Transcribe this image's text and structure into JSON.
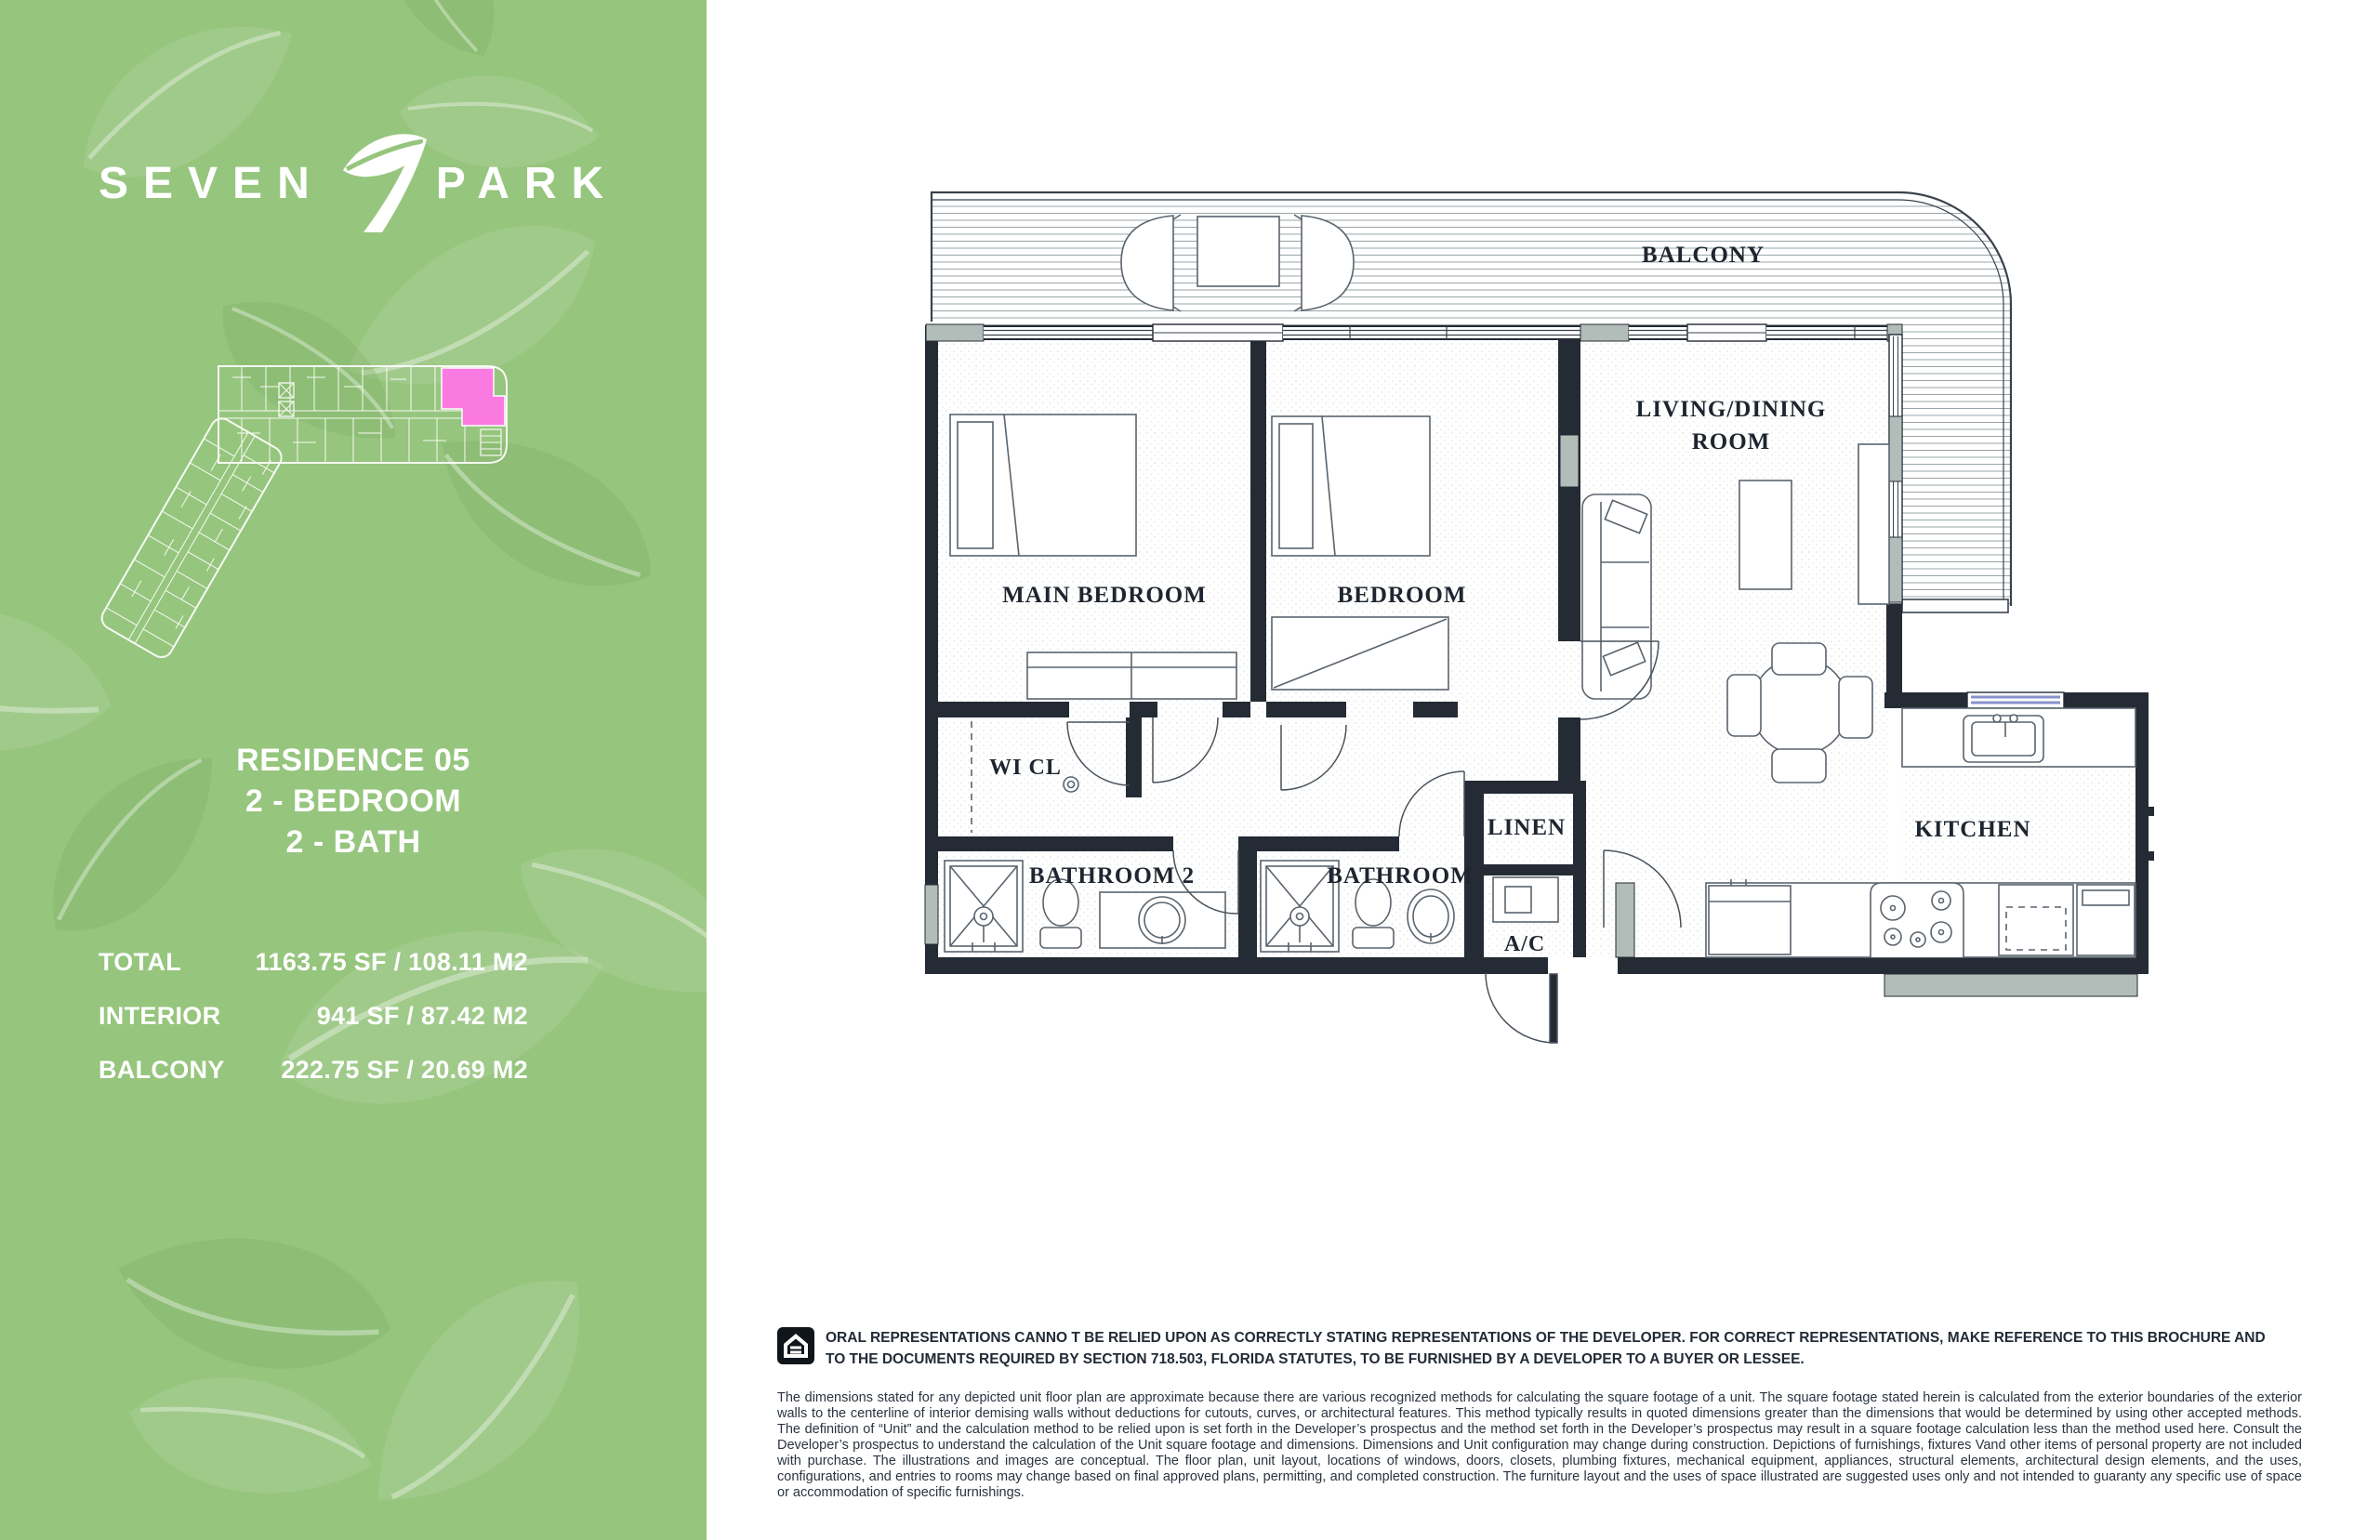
{
  "sidebar": {
    "logo": {
      "word1": "SEVEN",
      "word2": "PARK"
    },
    "residence": {
      "line1": "RESIDENCE 05",
      "line2": "2 - BEDROOM",
      "line3": "2 - BATH"
    },
    "areas": [
      {
        "label": "TOTAL",
        "value": "1163.75 SF / 108.11 M2"
      },
      {
        "label": "INTERIOR",
        "value": "941 SF / 87.42 M2"
      },
      {
        "label": "BALCONY",
        "value": "222.75 SF / 20.69 M2"
      }
    ]
  },
  "floorplan": {
    "rooms": {
      "balcony": "BALCONY",
      "main_bedroom": "MAIN BEDROOM",
      "bedroom": "BEDROOM",
      "living_line1": "LIVING/DINING",
      "living_line2": "ROOM",
      "wicl": "WI CL",
      "bathroom2": "BATHROOM 2",
      "bathroom": "BATHROOM",
      "linen": "LINEN",
      "ac": "A/C",
      "kitchen": "KITCHEN"
    }
  },
  "disclaimer": {
    "notice": "ORAL REPRESENTATIONS CANNO T BE RELIED UPON AS CORRECTLY STATING REPRESENTATIONS OF THE DEVELOPER. FOR CORRECT REPRESENTATIONS, MAKE REFERENCE TO THIS BROCHURE AND TO THE DOCUMENTS REQUIRED BY SECTION 718.503, FLORIDA STATUTES, TO BE FURNISHED BY A DEVELOPER TO A BUYER OR LESSEE.",
    "body": "The dimensions stated for any depicted unit floor plan are approximate because there are various recognized methods for calculating the square footage of a unit. The square footage stated herein is calculated from the exterior boundaries of the exterior walls to the centerline of interior demising walls without deductions for cutouts, curves, or architectural features. This method typically results in quoted dimensions greater than the dimensions that would be determined by using other accepted methods. The definition of “Unit” and the calculation method to be relied upon is set forth in the Developer’s prospectus and the method set forth in the Developer’s prospectus may result in a square footage calculation less than the method used here. Consult the Developer’s prospectus to understand the calculation of the Unit square footage and dimensions. Dimensions and Unit configuration may change during construction. Depictions of furnishings, fixtures Vand other items of personal property are not included with purchase. The illustrations and images are conceptual. The floor plan, unit layout, locations of windows, doors, closets, plumbing fixtures, mechanical equipment, appliances, structural elements, architectural design elements, and the uses, configurations, and entries to rooms may change based on final approved plans, permitting, and completed construction. The furniture layout and the uses of space illustrated are suggested uses only and not intended to guaranty any specific use of space or accommodation of specific furnishings."
  },
  "colors": {
    "sidebar_green": "#96c57d",
    "unit_highlight": "#fb7ae1",
    "plan_ink": "#242b34"
  }
}
